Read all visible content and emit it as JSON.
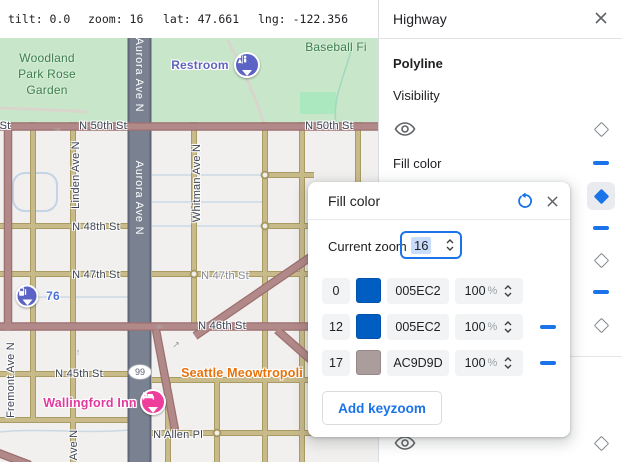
{
  "topbar": {
    "tilt": "tilt: 0.0",
    "zoom": "zoom: 16",
    "lat": "lat: 47.661",
    "lng": "lng: -122.356"
  },
  "map": {
    "labels": {
      "park_line1": "Woodland",
      "park_line2": "Park Rose",
      "park_line3": "Garden",
      "baseball": "Baseball Fi",
      "restroom": "Restroom",
      "st_partial": "St",
      "n50_center": "N 50th St",
      "n50_right": "N 50th St",
      "aurora_top": "Aurora Ave N",
      "aurora_mid": "Aurora Ave N",
      "linden": "Linden Ave N",
      "whitman": "Whitman Ave N",
      "fremont": "Fremont Ave N",
      "ave_n_partial": "Ave N",
      "n48": "N 48th St",
      "n47_left": "N 47th St",
      "n47_right": "N 47th St",
      "n46": "N 46th St",
      "n45": "N 45th St",
      "n_allen": "N Allen Pl",
      "gas": "76",
      "shield": "99",
      "hotel": "Wallingford Inn",
      "poi": "Seattle Meowtropoli"
    },
    "icons": {
      "restroom": "restroom-icon",
      "gas": "gas-station-icon",
      "hotel": "lodging-icon"
    }
  },
  "sidebar": {
    "title": "Highway",
    "section": "Polyline",
    "visibility_label": "Visibility",
    "fill_color_label": "Fill color"
  },
  "dialog": {
    "title": "Fill color",
    "current_zoom_label": "Current zoom",
    "current_zoom_value": "16",
    "opacity_suffix": "%",
    "stops": [
      {
        "zoom": "0",
        "hex": "005EC2",
        "color": "#005EC2",
        "opacity": "100"
      },
      {
        "zoom": "12",
        "hex": "005EC2",
        "color": "#005EC2",
        "opacity": "100"
      },
      {
        "zoom": "17",
        "hex": "AC9D9D",
        "color": "#AC9D9D",
        "opacity": "100"
      }
    ],
    "add_button_label": "Add keyzoom",
    "accent_color": "#1A73E8"
  }
}
